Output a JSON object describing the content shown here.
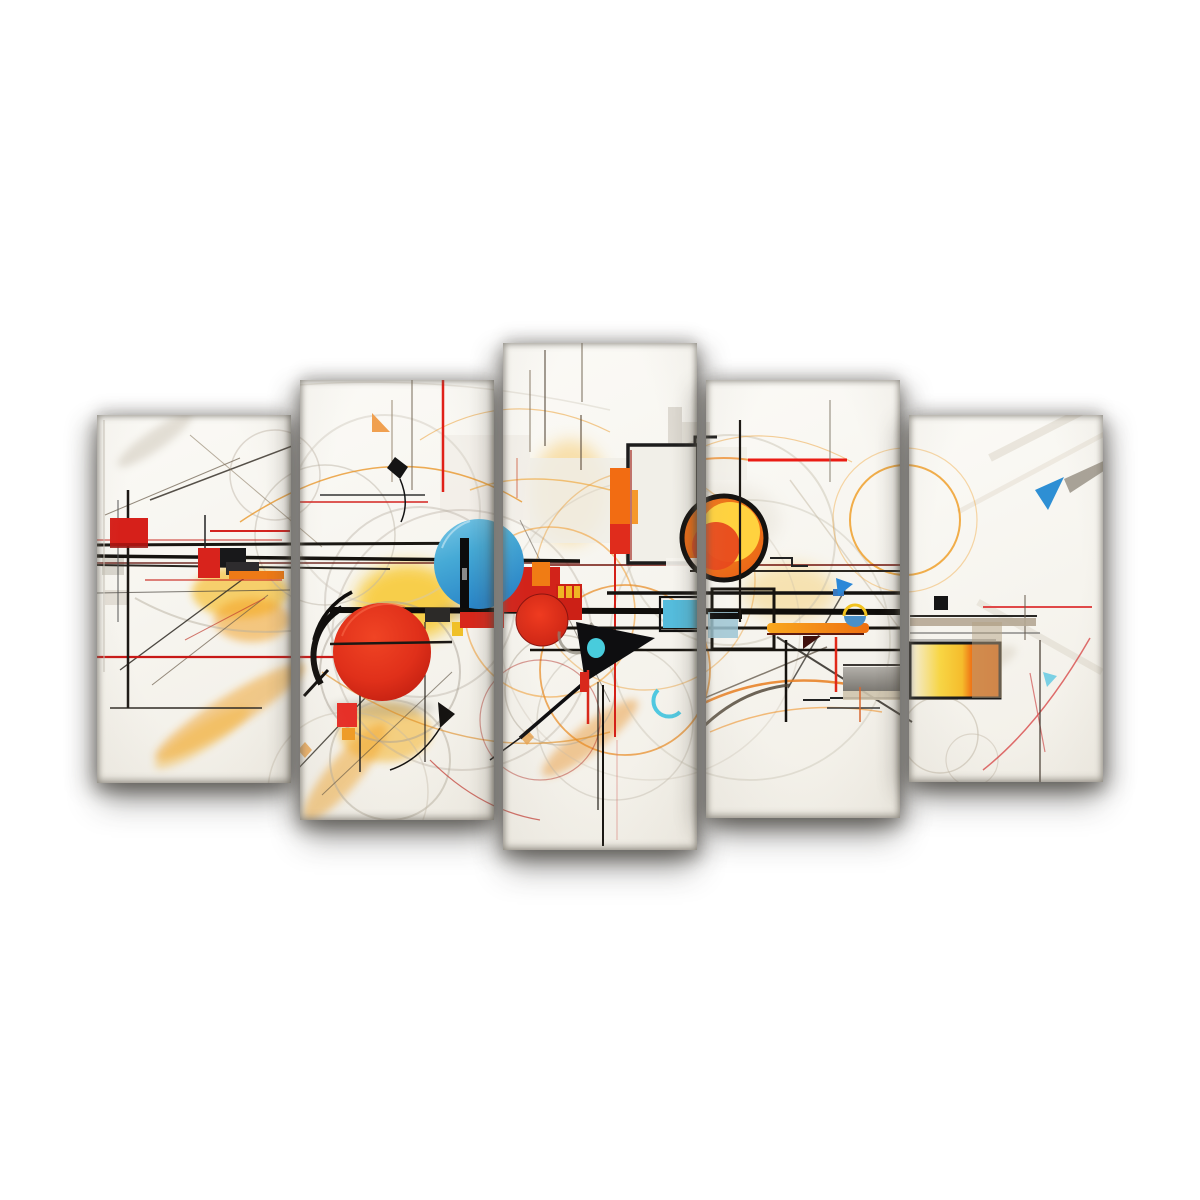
{
  "image": {
    "description": "Product mockup photo of a five-panel split canvas wall art set on a white background, showing an abstract geometric painting with circles, squares and fine line work spanning continuously across all five staggered panels.",
    "background_color": "#ffffff",
    "visible_text": []
  },
  "artwork": {
    "style": "abstract geometric line art",
    "palette": {
      "canvas_white": "#f8f6f1",
      "red": "#d8231c",
      "deep_red": "#c01e10",
      "orange": "#f07c14",
      "yellow": "#f8c83c",
      "sun_orange": "#f28a1c",
      "sun_yellow": "#ffd23f",
      "blue": "#2b88d8",
      "sky_blue": "#46aad6",
      "cyan": "#50c8e0",
      "pale_blue": "#9cc4d4",
      "black": "#141414",
      "maroon": "#6a201a",
      "tan": "#b5a794",
      "sketch_gray": "#c2baa8",
      "shadow_gray": "#9a9a9a"
    },
    "motifs": [
      "large red circle",
      "sky blue circle with black bar",
      "small red circle",
      "orange and yellow sun disc with black outline",
      "red squares",
      "black rectangle frame",
      "black triangle with cyan dot",
      "blue triangles",
      "cyan crescent",
      "yellow-orange framed rectangle",
      "long black and red horizontal lines",
      "thin sketchy arcs and diagonals"
    ]
  },
  "panel_count": 5,
  "artwork_origin": {
    "x": 90,
    "y": 340
  },
  "artwork_size": {
    "w": 1020,
    "h": 520
  },
  "panels": [
    {
      "id": "canvas-panel-1",
      "x": 97,
      "y": 415,
      "w": 194,
      "h": 368
    },
    {
      "id": "canvas-panel-2",
      "x": 300,
      "y": 380,
      "w": 194,
      "h": 440
    },
    {
      "id": "canvas-panel-3",
      "x": 503,
      "y": 343,
      "w": 194,
      "h": 507
    },
    {
      "id": "canvas-panel-4",
      "x": 706,
      "y": 380,
      "w": 194,
      "h": 438
    },
    {
      "id": "canvas-panel-5",
      "x": 909,
      "y": 415,
      "w": 194,
      "h": 367
    }
  ]
}
